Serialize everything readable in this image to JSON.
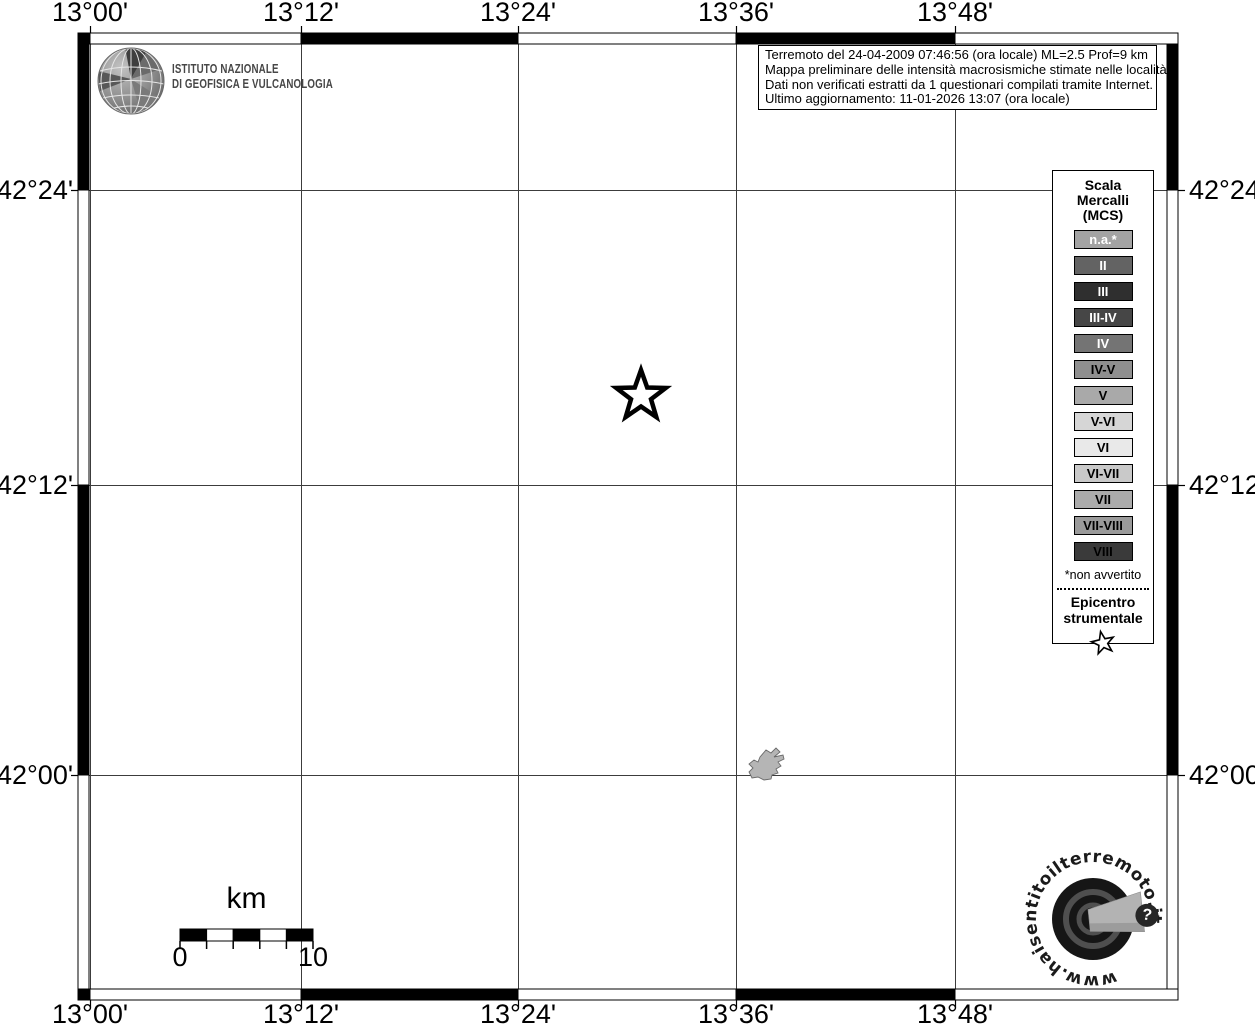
{
  "branding": {
    "institute_line1": "ISTITUTO NAZIONALE",
    "institute_line2": "DI GEOFISICA E VULCANOLOGIA"
  },
  "info_box": {
    "lines": [
      "Terremoto del 24-04-2009 07:46:56 (ora locale) ML=2.5 Prof=9 km",
      "Mappa preliminare delle intensità macrosismiche stimate nelle località",
      "Dati non verificati estratti da 1 questionari compilati tramite Internet.",
      "Ultimo aggiornamento: 11-01-2026 13:07 (ora locale)"
    ]
  },
  "legend": {
    "title": "Scala\nMercalli\n(MCS)",
    "items": [
      {
        "label": "n.a.*",
        "bg": "#a3a3a3",
        "fg": "#ffffff"
      },
      {
        "label": "II",
        "bg": "#636363",
        "fg": "#ffffff"
      },
      {
        "label": "III",
        "bg": "#2f2f2f",
        "fg": "#ffffff"
      },
      {
        "label": "III-IV",
        "bg": "#464646",
        "fg": "#ffffff"
      },
      {
        "label": "IV",
        "bg": "#747474",
        "fg": "#ffffff"
      },
      {
        "label": "IV-V",
        "bg": "#8f8f8f",
        "fg": "#000000"
      },
      {
        "label": "V",
        "bg": "#a9a9a9",
        "fg": "#000000"
      },
      {
        "label": "V-VI",
        "bg": "#d6d6d6",
        "fg": "#000000"
      },
      {
        "label": "VI",
        "bg": "#e9e9e9",
        "fg": "#000000"
      },
      {
        "label": "VI-VII",
        "bg": "#c9c9c9",
        "fg": "#000000"
      },
      {
        "label": "VII",
        "bg": "#ababab",
        "fg": "#000000"
      },
      {
        "label": "VII-VIII",
        "bg": "#9a9a9a",
        "fg": "#000000"
      },
      {
        "label": "VIII",
        "bg": "#3a3a3a",
        "fg": "#000000"
      }
    ],
    "footnote": "*non avvertito",
    "epicenter_label": "Epicentro\nstrumentale"
  },
  "map": {
    "lon_ticks": [
      {
        "label": "13°00'",
        "x": 90
      },
      {
        "label": "13°12'",
        "x": 301
      },
      {
        "label": "13°24'",
        "x": 518
      },
      {
        "label": "13°36'",
        "x": 736
      },
      {
        "label": "13°48'",
        "x": 955
      }
    ],
    "lat_ticks": [
      {
        "label": "42°24'",
        "y": 190
      },
      {
        "label": "42°12'",
        "y": 485
      },
      {
        "label": "42°00'",
        "y": 775
      }
    ],
    "epicenter": {
      "x": 641,
      "y": 396
    }
  },
  "scale_bar": {
    "unit_label": "km",
    "start_label": "0",
    "end_label": "10"
  },
  "watermark": {
    "url": "www.haisentitoilterremoto.it",
    "badge": "?"
  },
  "colors": {
    "band_dark": "#000000",
    "band_light": "#ffffff",
    "grid_line": "#3c3c3c",
    "lake_fill": "#b5b5b5",
    "lake_stroke": "#6a6a6a"
  }
}
